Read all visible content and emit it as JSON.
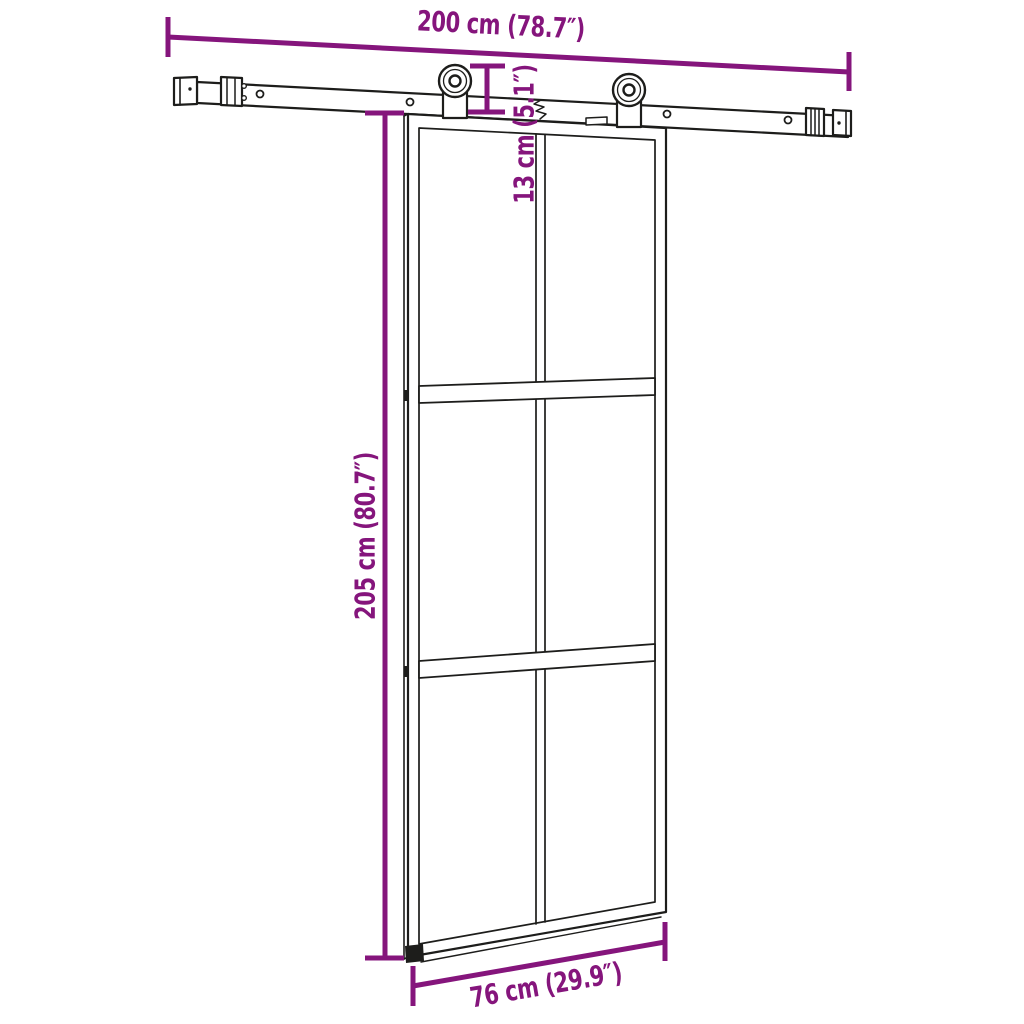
{
  "colors": {
    "dimension": "#85157c",
    "drawing": "#1d1d1b",
    "background": "#ffffff"
  },
  "dimensions": {
    "rail_length": {
      "label": "200 cm (78.7″)"
    },
    "door_height": {
      "label": "205 cm (80.7″)"
    },
    "drop_height": {
      "label": "13 cm (5.1″)"
    },
    "door_width": {
      "label": "76 cm (29.9″)"
    }
  }
}
